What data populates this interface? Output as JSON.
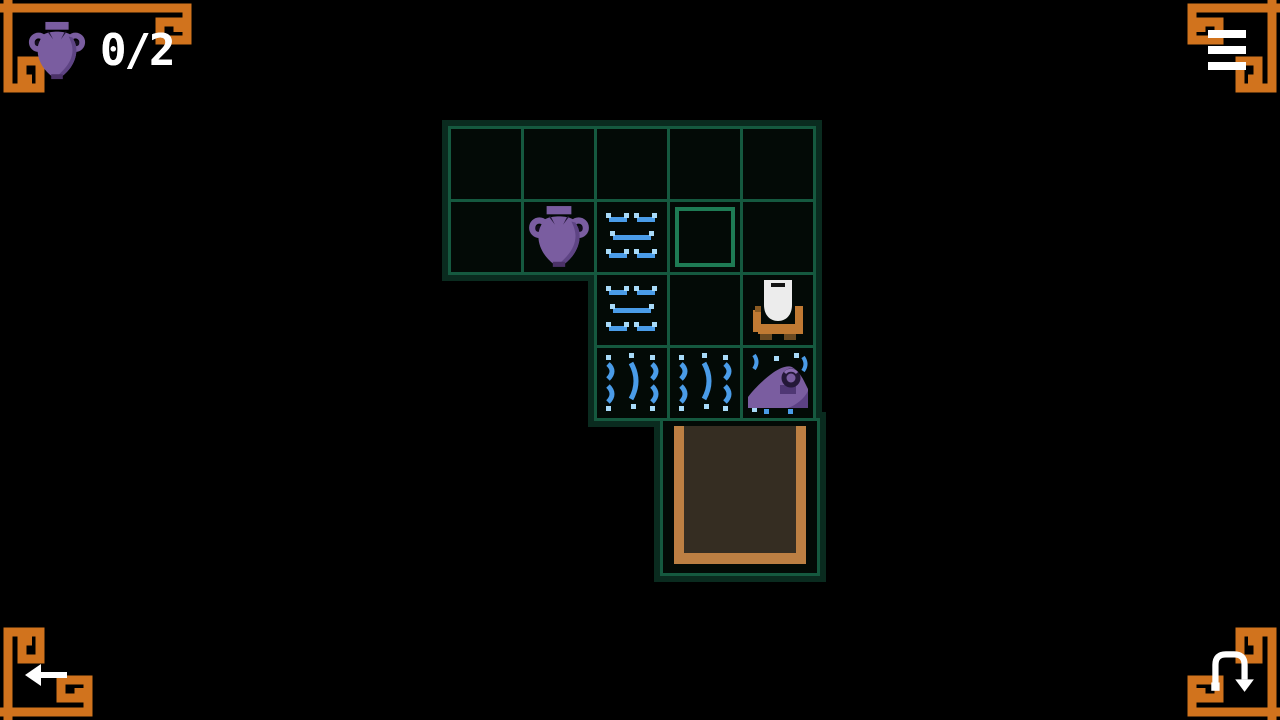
{
  "hud": {
    "amphora_counter": {
      "icon": "amphora-icon",
      "value": "0/2"
    }
  },
  "controls": {
    "menu": {
      "icon": "menu-icon"
    },
    "back": {
      "icon": "back-arrow-icon"
    },
    "undo": {
      "icon": "undo-icon"
    }
  },
  "colors": {
    "background": "#000000",
    "grid_line": "#15593f",
    "grid_outline": "#0a2b1f",
    "cell_bg": "#030a06",
    "socket_highlight": "#1e7b54",
    "ornament_orange": "#d1731d",
    "door_frame": "#bc7f43",
    "door_interior": "#352d22",
    "amphora_purple": "#7a5da0",
    "amphora_shade": "#5e4484",
    "water_blue": "#4a9ce8",
    "water_blue_light": "#a8daf8",
    "player_white": "#ececec",
    "player_orange": "#c07a33"
  },
  "grid": {
    "rows": 4,
    "cols": 5,
    "origin": {
      "x": 448,
      "y": 126
    },
    "pitch": 73,
    "cell_size": 76,
    "cells": [
      {
        "row": 0,
        "col": 0,
        "type": "empty"
      },
      {
        "row": 0,
        "col": 1,
        "type": "empty"
      },
      {
        "row": 0,
        "col": 2,
        "type": "empty"
      },
      {
        "row": 0,
        "col": 3,
        "type": "empty"
      },
      {
        "row": 0,
        "col": 4,
        "type": "empty"
      },
      {
        "row": 1,
        "col": 0,
        "type": "empty"
      },
      {
        "row": 1,
        "col": 1,
        "type": "amphora"
      },
      {
        "row": 1,
        "col": 2,
        "type": "water"
      },
      {
        "row": 1,
        "col": 3,
        "type": "socket"
      },
      {
        "row": 1,
        "col": 4,
        "type": "empty"
      },
      {
        "row": 2,
        "col": 2,
        "type": "water"
      },
      {
        "row": 2,
        "col": 3,
        "type": "empty"
      },
      {
        "row": 2,
        "col": 4,
        "type": "player"
      },
      {
        "row": 3,
        "col": 2,
        "type": "waterfall"
      },
      {
        "row": 3,
        "col": 3,
        "type": "waterfall"
      },
      {
        "row": 3,
        "col": 4,
        "type": "sunken-amphora"
      }
    ],
    "door": {
      "x": 660,
      "y": 418,
      "w": 160,
      "h": 158,
      "name": "exit-door"
    }
  }
}
